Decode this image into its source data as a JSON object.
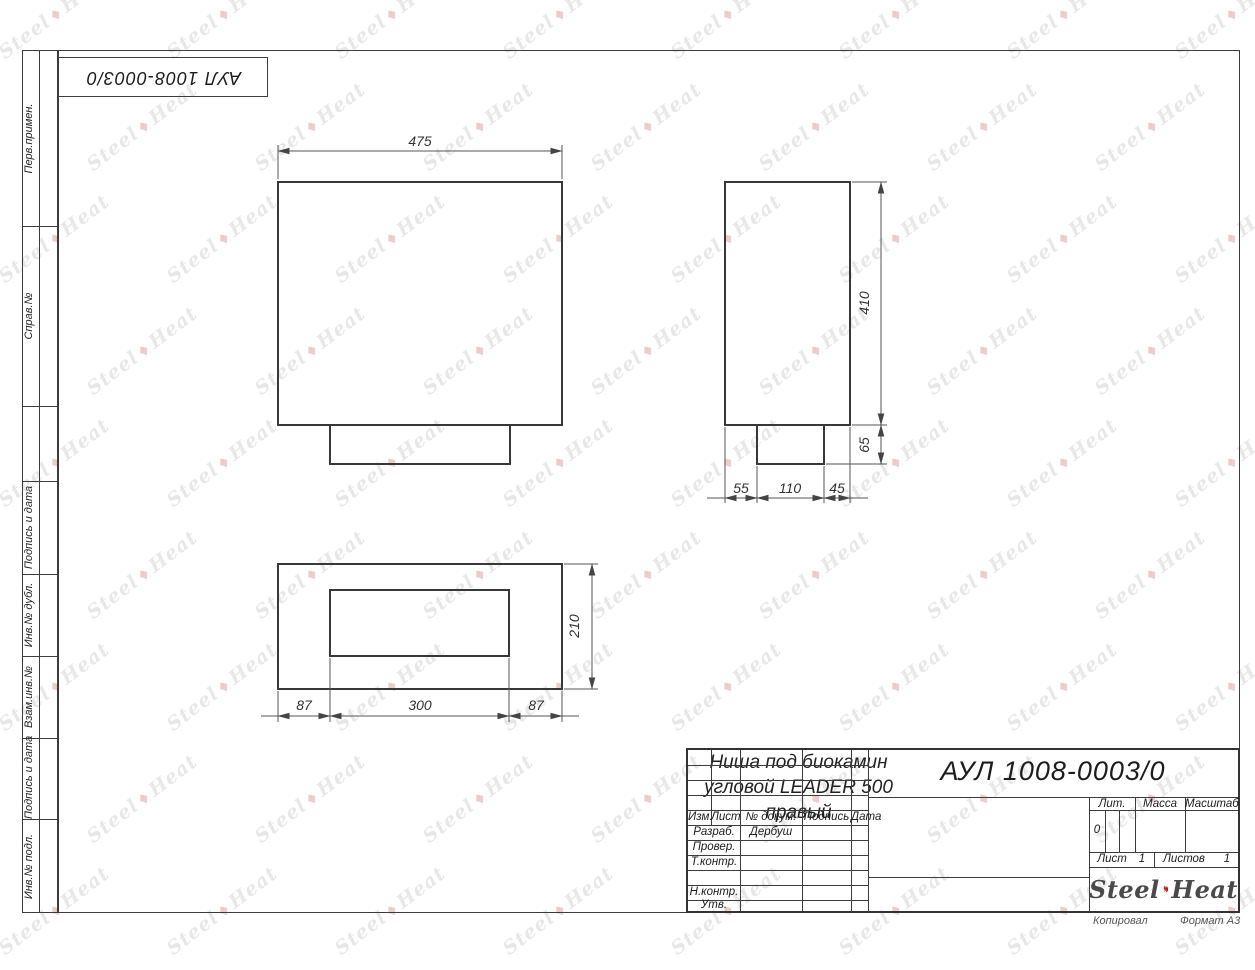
{
  "stamp": {
    "text": "АУЛ 1008-0003/0"
  },
  "margin_labels": {
    "perv": "Перв.примен.",
    "sprav": "Справ.№",
    "podpis1": "Подпись и дата",
    "inv_dubl": "Инв.№ дубл.",
    "vzam": "Взам.инв.№",
    "podpis2": "Подпись и дата",
    "inv_podl": "Инв.№ подл."
  },
  "dimensions": {
    "front_width": "475",
    "side_height": "410",
    "side_foot_height": "65",
    "side_bottom_1": "55",
    "side_bottom_2": "110",
    "side_bottom_3": "45",
    "plan_height": "210",
    "plan_bottom_1": "87",
    "plan_bottom_2": "300",
    "plan_bottom_3": "87"
  },
  "title_block": {
    "doc_number": "АУЛ 1008-0003/0",
    "title_line1": "Ниша под биокамин",
    "title_line2": "угловой LEADER 500",
    "title_line3": "правый",
    "col_izm": "Изм.",
    "col_list": "Лист",
    "col_doc": "№ докум.",
    "col_sign": "Подпись",
    "col_date": "Дата",
    "row_razrab": "Разраб.",
    "row_razrab_value": "Дербуш",
    "row_prover": "Провер.",
    "row_tkontr": "Т.контр.",
    "row_nkontr": "Н.контр.",
    "row_utv": "Утв.",
    "lit_label": "Лит.",
    "lit_value": "0",
    "mass_label": "Масса",
    "scale_label": "Масштаб",
    "sheet_label": "Лист",
    "sheet_value": "1",
    "sheets_label": "Листов",
    "sheets_value": "1",
    "logo_steel": "Steel",
    "logo_heat": "Heat"
  },
  "footer": {
    "copy": "Копировал",
    "format": "Формат А3"
  },
  "watermark": {
    "steel": "Steel",
    "heat": "Heat",
    "mark": "♦"
  },
  "colors": {
    "line": "#3c3c3c",
    "flame_red": "#e2261f",
    "flame_dark": "#c81812",
    "logo_text": "#4a4a4a"
  }
}
